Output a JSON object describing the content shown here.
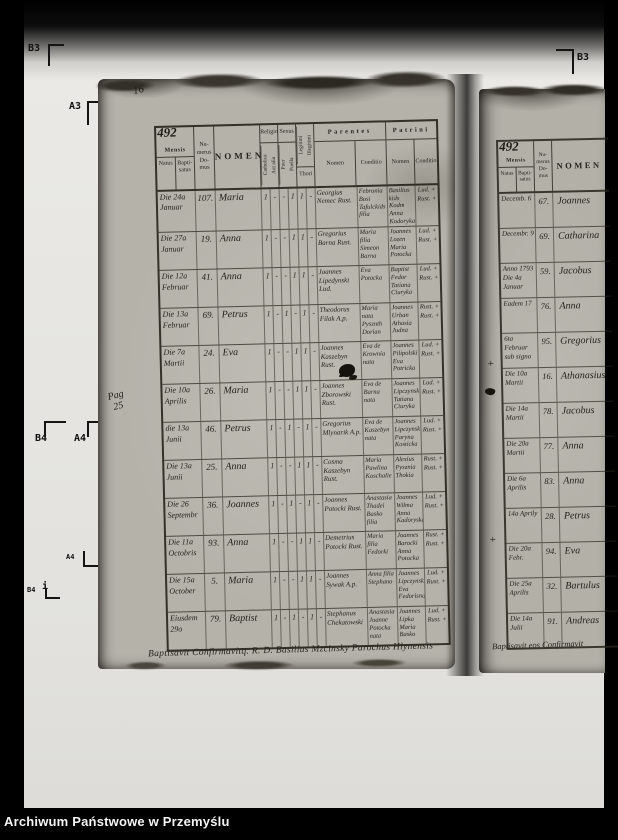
{
  "caption": "Archiwum Państwowe w Przemyślu",
  "marks": {
    "b3_left": "B3",
    "a3_left": "A3",
    "b3_right": "B3",
    "b4_left": "B4",
    "a4_left": "A4",
    "a4_small": "A4",
    "b4_small": "B4",
    "b4_small_i": "i"
  },
  "margin": {
    "folio_corner": "16",
    "pag_note_line1": "Pag",
    "pag_note_line2": "25",
    "plus_1": "+",
    "plus_2": "+"
  },
  "left_page": {
    "page_no": "492",
    "header": {
      "mensis": "Mensis",
      "natus": "Natus",
      "baptisatus": "Bapti- satus",
      "numerus_domus": "Nu- merus Do- mus",
      "nomen": "NOMEN",
      "religio": "Religio",
      "catholica": "Catholica",
      "aut_alia": "Aut alia",
      "sexus": "Sexus",
      "puer": "Puer",
      "puella": "Puella",
      "legitimi": "Legitimi",
      "illegitimi": "Illegitimi",
      "thori": "Thori",
      "parentes": "Parentes",
      "parentes_nomen": "Nomen",
      "parentes_conditio": "Conditio",
      "patrini": "Patrini",
      "patrini_nomen": "Nomen",
      "patrini_conditio": "Conditio"
    },
    "rows": [
      {
        "natus": "Die 24a Januar",
        "num": "107.",
        "nomen": "Maria",
        "marks": [
          "1",
          "-",
          "-",
          "1",
          "1",
          "-"
        ],
        "par_nomen": "Georgius Nemec Rust.",
        "par_cond": "Febronia Bosi Tafulckids filia",
        "pat_nomen": "Basilius kids Kodm Anna Kodoryka",
        "pat_cond": "Lud. + Rust. +"
      },
      {
        "natus": "Die 27a Januar",
        "num": "19.",
        "nomen": "Anna",
        "marks": [
          "1",
          "-",
          "-",
          "1",
          "1",
          "-"
        ],
        "par_nomen": "Gregorius Barna Rust.",
        "par_cond": "Maria filia Simeon Barna",
        "pat_nomen": "Joannes Lozen Maria Potocka",
        "pat_cond": "Lud. + Rust. +"
      },
      {
        "natus": "Die 12a Februar",
        "num": "41.",
        "nomen": "Anna",
        "marks": [
          "1",
          "-",
          "-",
          "1",
          "1",
          "-"
        ],
        "par_nomen": "Joannes Lipedynski Lud.",
        "par_cond": "Eva Potocka",
        "pat_nomen": "Baptist Fedor Tatiana Ciuryka",
        "pat_cond": "Lud. + Rust. +"
      },
      {
        "natus": "Die 13a Februar",
        "num": "69.",
        "nomen": "Petrus",
        "marks": [
          "1",
          "-",
          "1",
          "-",
          "1",
          "-"
        ],
        "par_nomen": "Theodorus Filak A.p.",
        "par_cond": "Maria nata Pysznth Dorian",
        "pat_nomen": "Joannes Urban Athasia Judna",
        "pat_cond": "Rust. + Rust. +"
      },
      {
        "natus": "Die 7a Martii",
        "num": "24.",
        "nomen": "Eva",
        "marks": [
          "1",
          "-",
          "-",
          "1",
          "1",
          "-"
        ],
        "par_nomen": "Joannes Kaszebyn Rust.",
        "par_cond": "Eva de Krownia nata",
        "pat_nomen": "Joannes Pilipolski Eva Potricka",
        "pat_cond": "Lud. + Rust. +"
      },
      {
        "natus": "Die 10a Aprilis",
        "num": "26.",
        "nomen": "Maria",
        "marks": [
          "1",
          "-",
          "-",
          "1",
          "1",
          "-"
        ],
        "par_nomen": "Joannes Zborowski Rust.",
        "par_cond": "Eva de Barna nata",
        "pat_nomen": "Joannes Lipczynski Tatiana Ciuryka",
        "pat_cond": "Lud. + Rust. +"
      },
      {
        "natus": "die 13a Junii",
        "num": "46.",
        "nomen": "Petrus",
        "marks": [
          "1",
          "-",
          "1",
          "-",
          "1",
          "-"
        ],
        "par_nomen": "Gregorius Mlynarik A.p.",
        "par_cond": "Eva de Kaszebyn nata",
        "pat_nomen": "Joannes Lipczynski Paryna Kosticka",
        "pat_cond": "Lud. + Rust. +"
      },
      {
        "natus": "Die 13a Junii",
        "num": "25.",
        "nomen": "Anna",
        "marks": [
          "1",
          "-",
          "-",
          "1",
          "1",
          "-"
        ],
        "par_nomen": "Cosma Kaszebyn Rust.",
        "par_cond": "Maria Pawlina Koschalie",
        "pat_nomen": "Alexius Pysznia Thokia",
        "pat_cond": "Rust. + Rust. +"
      },
      {
        "natus": "Die 26 Septembr",
        "num": "36.",
        "nomen": "Joannes",
        "marks": [
          "1",
          "-",
          "1",
          "-",
          "1",
          "-"
        ],
        "par_nomen": "Joannes Potocki Rust.",
        "par_cond": "Anastasia Thadei Basko filia",
        "pat_nomen": "Joannes Wilma Anna Kadoryska",
        "pat_cond": "Lud. + Rust. +"
      },
      {
        "natus": "Die 11a Octobris",
        "num": "93.",
        "nomen": "Anna",
        "marks": [
          "1",
          "-",
          "-",
          "1",
          "1",
          "-"
        ],
        "par_nomen": "Demetrius Potocki Rust.",
        "par_cond": "Maria filia Fedorki",
        "pat_nomen": "Joannes Barocki Anna Potocka",
        "pat_cond": "Rust. + Rust. +"
      },
      {
        "natus": "Die 15a October",
        "num": "5.",
        "nomen": "Maria",
        "marks": [
          "1",
          "-",
          "-",
          "1",
          "1",
          "-"
        ],
        "par_nomen": "Joannes Sywak A.p.",
        "par_cond": "Anna filia Stephano",
        "pat_nomen": "Joannes Lipczynski Eva Fedorisna",
        "pat_cond": "Lud. + Rust. +"
      },
      {
        "natus": "Eiusdem 29o",
        "num": "79.",
        "nomen": "Baptist",
        "marks": [
          "1",
          "-",
          "1",
          "-",
          "1",
          "-"
        ],
        "par_nomen": "Stephanus Chekatowski",
        "par_cond": "Anastasia Joanne Potocka nata",
        "pat_nomen": "Joannes Lipka Maria Basko",
        "pat_cond": "Lud. + Rust. +"
      }
    ],
    "footer_note": "Baptisavit Confirmavitq. R. D. Basilius Mzcinsky Parochus Hlynensis"
  },
  "right_page": {
    "page_no": "492",
    "header": {
      "mensis": "Mensis",
      "natus": "Natus",
      "baptisatus": "Bapti- satus",
      "numerus_domus": "Nu- merus Do- mus",
      "nomen": "NOMEN"
    },
    "rows": [
      {
        "natus": "Decemb. 6",
        "num": "67.",
        "nomen": "Joannes"
      },
      {
        "natus": "Decembr. 9",
        "num": "69.",
        "nomen": "Catharina"
      },
      {
        "natus": "Anno 1793 Die 4a Januar",
        "num": "59.",
        "nomen": "Jacobus"
      },
      {
        "natus": "Eadem 17",
        "num": "76.",
        "nomen": "Anna"
      },
      {
        "natus": "6ta Februar sub signo",
        "num": "95.",
        "nomen": "Gregorius"
      },
      {
        "natus": "Die 10a Martii",
        "num": "16.",
        "nomen": "Athanasius"
      },
      {
        "natus": "Die 14a Martii",
        "num": "78.",
        "nomen": "Jacobus"
      },
      {
        "natus": "Die 20a Martii",
        "num": "77.",
        "nomen": "Anna"
      },
      {
        "natus": "Die 6a Aprilis",
        "num": "83.",
        "nomen": "Anna"
      },
      {
        "natus": "14a Aprily",
        "num": "28.",
        "nomen": "Petrus"
      },
      {
        "natus": "Die 20a Febr.",
        "num": "94.",
        "nomen": "Eva"
      },
      {
        "natus": "Die 25a Aprilis",
        "num": "32.",
        "nomen": "Bartulus"
      },
      {
        "natus": "Die 14a Julii",
        "num": "91.",
        "nomen": "Andreas"
      }
    ],
    "footer_note": "Baptisavit eos Confirmavit"
  }
}
